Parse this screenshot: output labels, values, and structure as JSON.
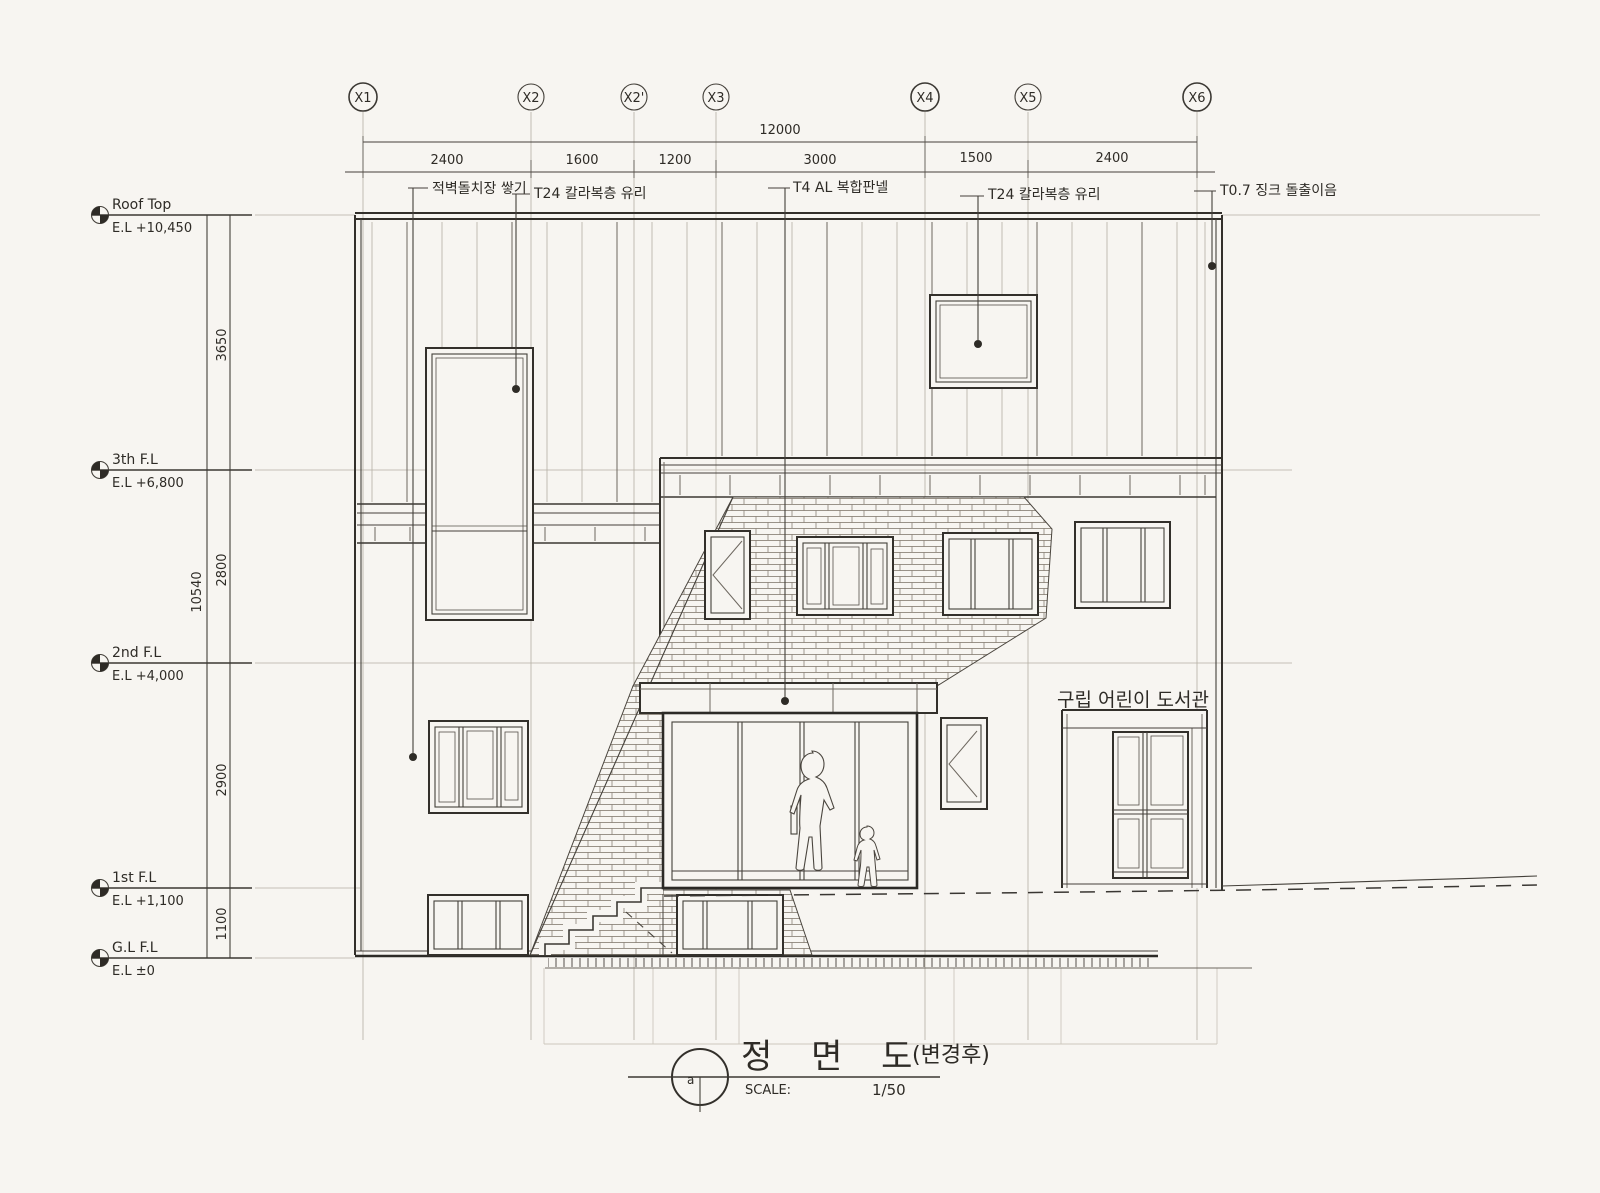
{
  "drawing": {
    "title": {
      "main": "정 면 도",
      "suffix": "(변경후)",
      "scale_label": "SCALE:",
      "scale_value": "1/50",
      "bubble": "a"
    },
    "grid": {
      "labels": [
        "X1",
        "X2",
        "X2'",
        "X3",
        "X4",
        "X5",
        "X6"
      ],
      "overall_dim": "12000",
      "segment_dims": [
        "2400",
        "1600",
        "1200",
        "3000",
        "1500",
        "2400"
      ]
    },
    "levels": [
      {
        "name": "Roof Top",
        "elevation": "E.L +10,450"
      },
      {
        "name": "3th F.L",
        "elevation": "E.L +6,800"
      },
      {
        "name": "2nd F.L",
        "elevation": "E.L +4,000"
      },
      {
        "name": "1st F.L",
        "elevation": "E.L +1,100"
      },
      {
        "name": "G.L F.L",
        "elevation": "E.L ±0"
      }
    ],
    "vertical_dims": {
      "overall": "10540",
      "segments": [
        "3650",
        "2800",
        "2900",
        "1100"
      ]
    },
    "callouts": [
      "적벽돌치장 쌓기",
      "T24 칼라복층 유리",
      "T4 AL 복합판넬",
      "T24 칼라복층 유리",
      "T0.7 징크 돌출이음"
    ],
    "sign": "구립 어린이 도서관",
    "colors": {
      "paper": "#f7f5f1",
      "ink": "#2e2b26",
      "pencil": "#b4afa4"
    }
  }
}
